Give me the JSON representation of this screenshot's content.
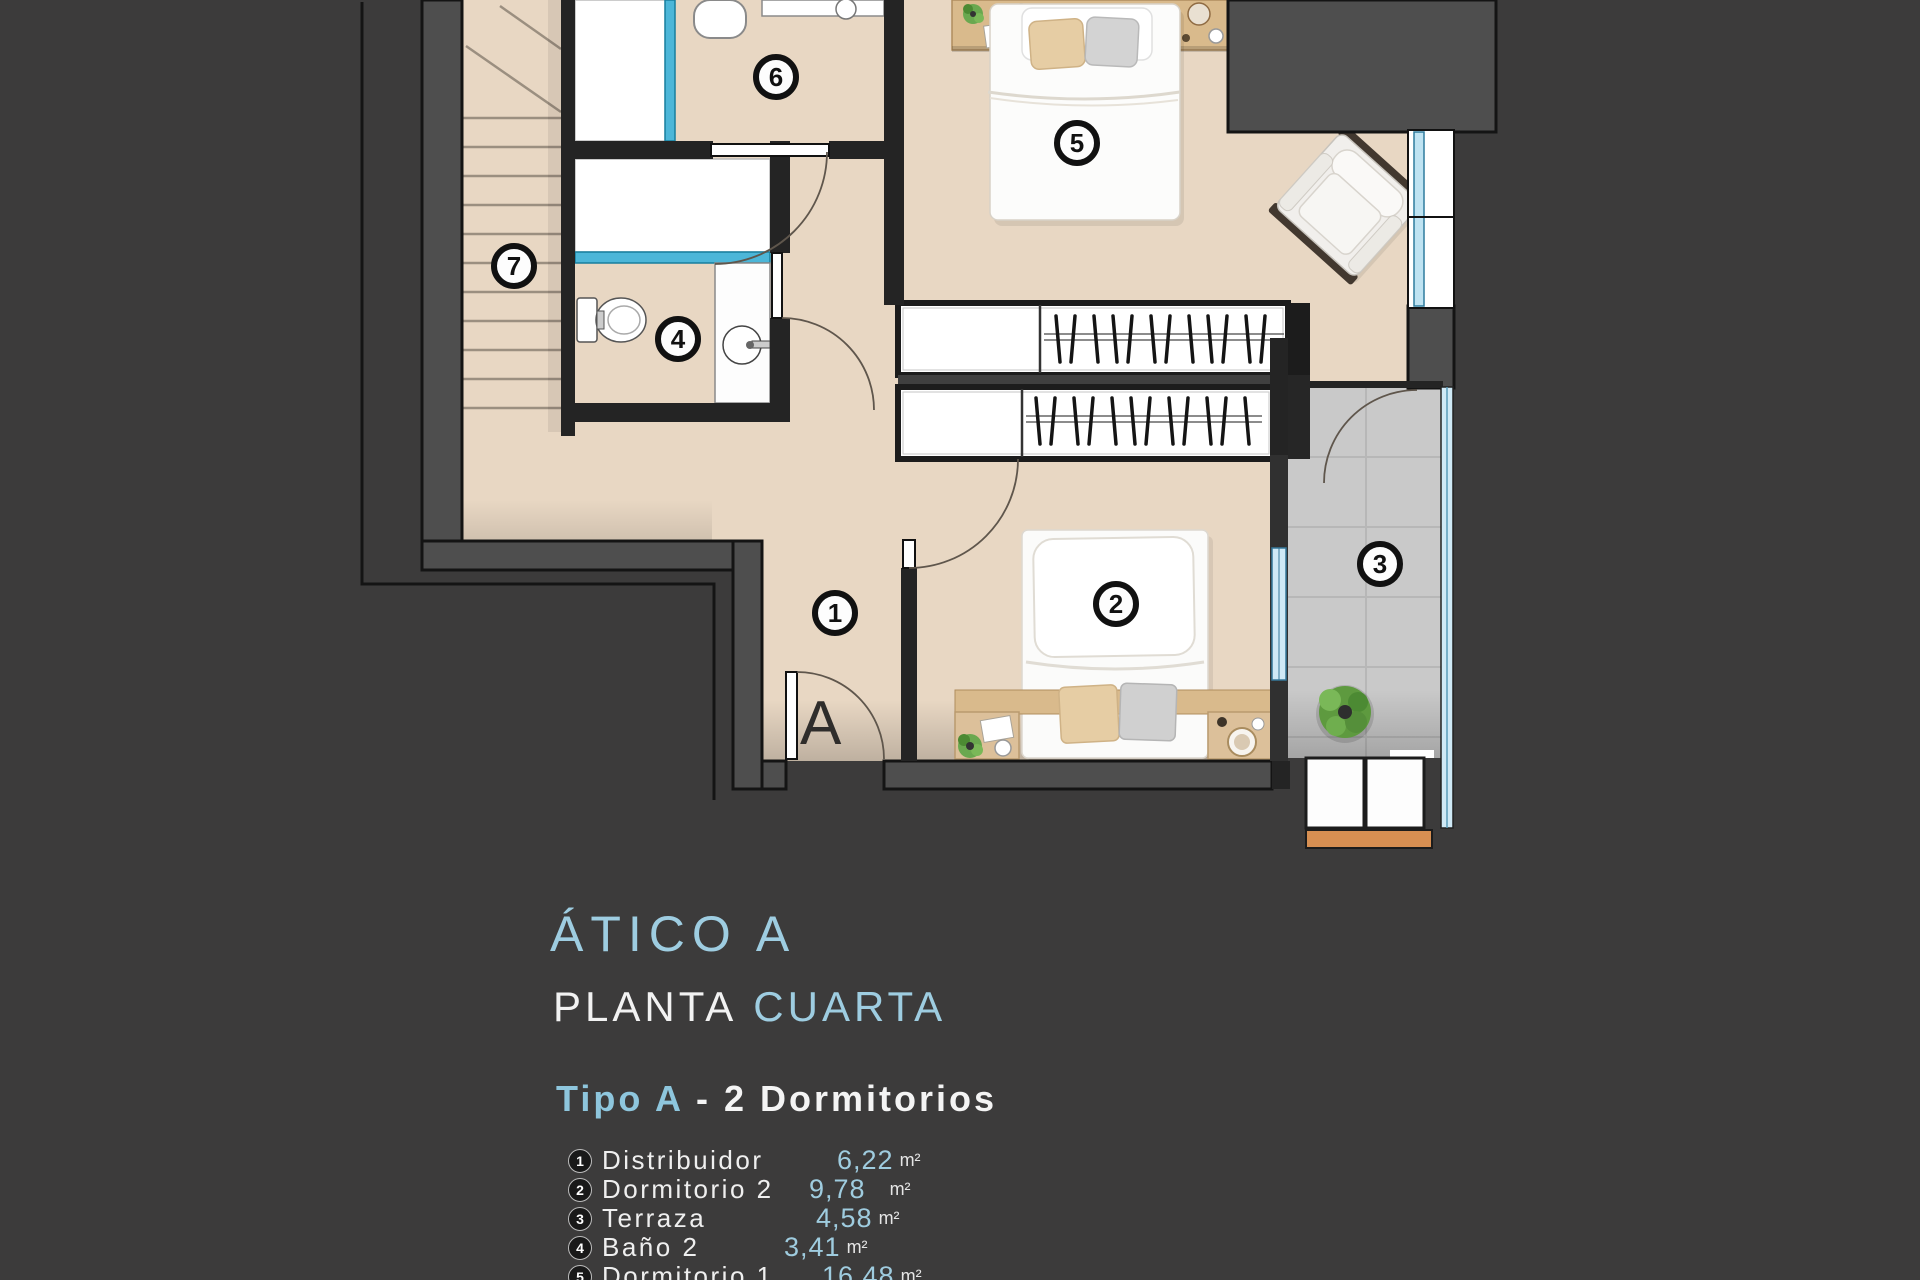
{
  "header": {
    "title_line1": "ÁTICO A",
    "title_line2_part1": "PLANTA",
    "title_line2_part2": "CUARTA",
    "subtitle_part1": "Tipo A",
    "subtitle_part2": "- 2  Dormitorios"
  },
  "legend": {
    "items": [
      {
        "num": "1",
        "name": "Distribuidor",
        "area": "6,22",
        "unit": "m²"
      },
      {
        "num": "2",
        "name": "Dormitorio 2",
        "area": "9,78",
        "unit": "m²"
      },
      {
        "num": "3",
        "name": "Terraza",
        "area": "4,58",
        "unit": "m²"
      },
      {
        "num": "4",
        "name": "Baño 2",
        "area": "3,41",
        "unit": "m²"
      },
      {
        "num": "5",
        "name": "Dormitorio 1",
        "area": "16,48",
        "unit": "m²"
      }
    ]
  },
  "plan": {
    "entrance_label": "A",
    "markers": [
      {
        "num": "1",
        "room": "Distribuidor"
      },
      {
        "num": "2",
        "room": "Dormitorio 2"
      },
      {
        "num": "3",
        "room": "Terraza"
      },
      {
        "num": "4",
        "room": "Baño 2"
      },
      {
        "num": "5",
        "room": "Dormitorio 1"
      },
      {
        "num": "6",
        "room": "Baño 1"
      },
      {
        "num": "7",
        "room": "Escalera"
      }
    ],
    "colors": {
      "background": "#3c3b3b",
      "floor": "#e8d7c3",
      "terrace_tile": "#c9c9c9",
      "exterior_wall": "#4e4e4e",
      "interior_wall": "#242424",
      "shower_glass": "#4cb6d8",
      "window_glass": "#cfe9f6",
      "wood": "#d9ba8c",
      "orange_trim": "#d78f52",
      "accent_blue": "#9ecde1"
    }
  }
}
